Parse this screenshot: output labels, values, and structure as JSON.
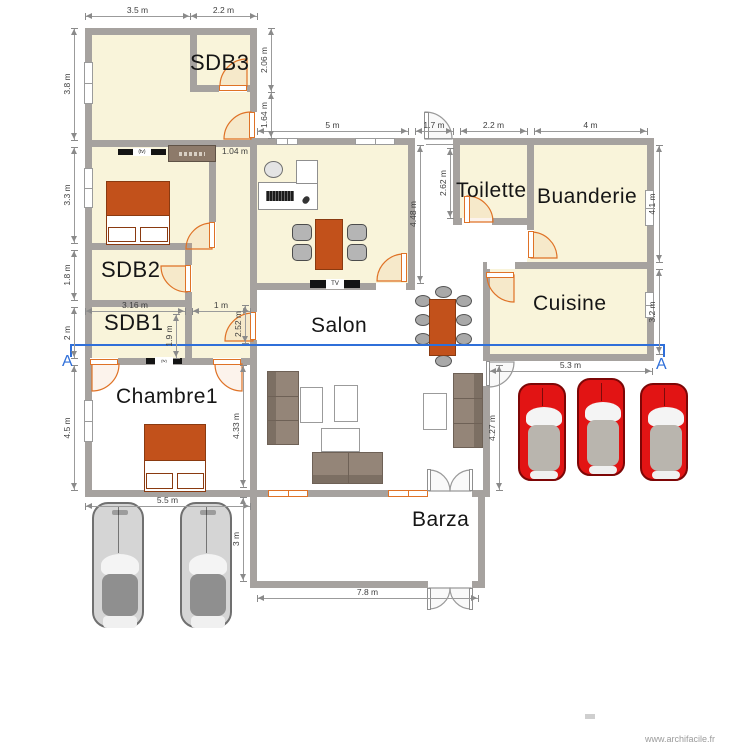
{
  "watermark": {
    "text": "www.archifacile.fr"
  },
  "plan": {
    "colors": {
      "room_fill": "#f9f4da",
      "wall": "#a6a29f",
      "door": "#df7226",
      "bed": "#c2511b",
      "bed_border": "#8a3a10",
      "wardrobe": "#8d7a6a",
      "chair": "#b5b5b5",
      "sofa": "#948578",
      "sofa_dark": "#7c6f63",
      "sofa_border": "#6e6156",
      "car_red": "#e21414",
      "car_gray": "#d5d5d5",
      "section": "#2f6fd9",
      "dim_line": "#9b9b9b",
      "dim": "#8a8a8a",
      "dim_text": "#3f3f3f"
    },
    "rooms_beige": [
      [
        85,
        28,
        172,
        119
      ],
      [
        85,
        140,
        172,
        225
      ],
      [
        250,
        138,
        165,
        152
      ],
      [
        453,
        138,
        81,
        87
      ],
      [
        527,
        138,
        127,
        131
      ],
      [
        483,
        262,
        171,
        99
      ]
    ],
    "walls": [
      [
        85,
        28,
        172,
        7
      ],
      [
        85,
        28,
        7,
        119
      ],
      [
        190,
        28,
        7,
        64
      ],
      [
        250,
        28,
        7,
        119
      ],
      [
        190,
        85,
        67,
        7
      ],
      [
        85,
        140,
        172,
        7
      ],
      [
        85,
        140,
        7,
        225
      ],
      [
        209,
        147,
        7,
        101
      ],
      [
        85,
        243,
        107,
        7
      ],
      [
        185,
        243,
        7,
        122
      ],
      [
        85,
        300,
        107,
        7
      ],
      [
        250,
        147,
        7,
        218
      ],
      [
        85,
        358,
        172,
        7
      ],
      [
        85,
        358,
        7,
        139
      ],
      [
        250,
        365,
        7,
        132
      ],
      [
        85,
        490,
        172,
        7
      ],
      [
        250,
        138,
        165,
        7
      ],
      [
        408,
        138,
        7,
        152
      ],
      [
        250,
        283,
        165,
        7
      ],
      [
        453,
        138,
        201,
        7
      ],
      [
        453,
        138,
        7,
        87
      ],
      [
        453,
        218,
        81,
        7
      ],
      [
        527,
        138,
        7,
        99
      ],
      [
        483,
        262,
        171,
        7
      ],
      [
        647,
        138,
        7,
        223
      ],
      [
        483,
        262,
        7,
        99
      ],
      [
        483,
        354,
        171,
        7
      ],
      [
        483,
        354,
        7,
        143
      ],
      [
        250,
        490,
        235,
        7
      ],
      [
        250,
        490,
        7,
        98
      ],
      [
        478,
        490,
        7,
        98
      ],
      [
        250,
        581,
        235,
        7
      ]
    ],
    "door_openings": [
      [
        219,
        85,
        28,
        7
      ],
      [
        250,
        112,
        7,
        26
      ],
      [
        209,
        222,
        7,
        26
      ],
      [
        185,
        265,
        7,
        27
      ],
      [
        250,
        312,
        7,
        28
      ],
      [
        90,
        358,
        28,
        7
      ],
      [
        213,
        358,
        28,
        7
      ],
      [
        462,
        218,
        30,
        7
      ],
      [
        527,
        230,
        7,
        28
      ],
      [
        487,
        262,
        28,
        7
      ],
      [
        376,
        283,
        30,
        7
      ],
      [
        428,
        490,
        44,
        7
      ],
      [
        428,
        581,
        44,
        7
      ],
      [
        483,
        361,
        7,
        25
      ]
    ],
    "thresholds": [
      [
        426,
        138,
        27,
        7
      ]
    ],
    "windows_white": [
      [
        84,
        62,
        9,
        42
      ],
      [
        84,
        168,
        9,
        40
      ],
      [
        84,
        400,
        9,
        42
      ],
      [
        276,
        138,
        22,
        7
      ],
      [
        355,
        138,
        40,
        7
      ],
      [
        645,
        190,
        9,
        36
      ],
      [
        645,
        292,
        9,
        26
      ]
    ],
    "windows_orange": [
      [
        268,
        490,
        40,
        7
      ],
      [
        388,
        490,
        40,
        7
      ]
    ],
    "door_leaves": [
      [
        219,
        85,
        28,
        6,
        "o"
      ],
      [
        249,
        112,
        6,
        26,
        "o"
      ],
      [
        209,
        222,
        6,
        26,
        "o"
      ],
      [
        185,
        265,
        6,
        27,
        "o"
      ],
      [
        250,
        312,
        6,
        28,
        "o"
      ],
      [
        90,
        359,
        28,
        6,
        "o"
      ],
      [
        213,
        359,
        28,
        6,
        "o"
      ],
      [
        424,
        112,
        5,
        27,
        "g"
      ],
      [
        464,
        196,
        6,
        27,
        "o"
      ],
      [
        528,
        231,
        6,
        27,
        "o"
      ],
      [
        486,
        272,
        28,
        6,
        "o"
      ],
      [
        401,
        253,
        6,
        29,
        "o"
      ],
      [
        427,
        469,
        4,
        22,
        "g"
      ],
      [
        469,
        469,
        4,
        22,
        "g"
      ],
      [
        427,
        588,
        4,
        22,
        "g"
      ],
      [
        469,
        588,
        4,
        22,
        "g"
      ],
      [
        486,
        361,
        4,
        25,
        "g"
      ]
    ],
    "door_arcs": [
      [
        247,
        86,
        27,
        180,
        270,
        "o"
      ],
      [
        251,
        139,
        27,
        270,
        180,
        "o"
      ],
      [
        212,
        249,
        26,
        270,
        180,
        "o"
      ],
      [
        187,
        266,
        26,
        90,
        180,
        "o"
      ],
      [
        253,
        341,
        28,
        270,
        180,
        "o"
      ],
      [
        92,
        364,
        27,
        0,
        90,
        "o"
      ],
      [
        242,
        364,
        27,
        180,
        90,
        "o"
      ],
      [
        425,
        139,
        27,
        270,
        0,
        "g"
      ],
      [
        467,
        222,
        26,
        270,
        0,
        "o"
      ],
      [
        531,
        258,
        26,
        270,
        0,
        "o"
      ],
      [
        514,
        275,
        27,
        180,
        90,
        "o"
      ],
      [
        404,
        281,
        27,
        270,
        180,
        "o"
      ],
      [
        429,
        491,
        21,
        270,
        0,
        "g"
      ],
      [
        471,
        491,
        21,
        270,
        180,
        "g"
      ],
      [
        429,
        588,
        21,
        90,
        0,
        "g"
      ],
      [
        471,
        588,
        21,
        90,
        180,
        "g"
      ],
      [
        489,
        362,
        25,
        90,
        0,
        "g"
      ]
    ],
    "dims_h": [
      [
        85,
        190,
        16,
        "3.5 m"
      ],
      [
        190,
        257,
        16,
        "2.2 m"
      ],
      [
        257,
        408,
        131,
        "5 m"
      ],
      [
        415,
        453,
        131,
        "1.7 m"
      ],
      [
        460,
        527,
        131,
        "2.2 m"
      ],
      [
        534,
        647,
        131,
        "4 m"
      ],
      [
        85,
        185,
        311,
        "3.16 m"
      ],
      [
        192,
        250,
        311,
        "1 m"
      ],
      [
        489,
        652,
        371,
        "5.3 m"
      ],
      [
        85,
        250,
        506,
        "5.5 m"
      ],
      [
        257,
        478,
        598,
        "7.8 m"
      ]
    ],
    "dims_v": [
      [
        74,
        28,
        140,
        "3.8 m"
      ],
      [
        74,
        147,
        243,
        "3.3 m"
      ],
      [
        74,
        250,
        300,
        "1.8 m"
      ],
      [
        74,
        307,
        358,
        "2 m"
      ],
      [
        74,
        365,
        490,
        "4.5 m"
      ],
      [
        271,
        28,
        92,
        "2.06 m"
      ],
      [
        271,
        92,
        138,
        "1.64 m"
      ],
      [
        176,
        314,
        358,
        "1.9 m"
      ],
      [
        245,
        305,
        343,
        "2.52 m"
      ],
      [
        420,
        145,
        283,
        "4.48 m"
      ],
      [
        450,
        148,
        218,
        "2.62 m"
      ],
      [
        659,
        145,
        262,
        "4.1 m"
      ],
      [
        659,
        269,
        354,
        "3.2 m"
      ],
      [
        499,
        365,
        490,
        "4.27 m"
      ],
      [
        243,
        365,
        487,
        "4.33 m"
      ],
      [
        243,
        497,
        581,
        "3 m"
      ]
    ],
    "dim_labels_free": [
      [
        222,
        146,
        "1.04 m"
      ]
    ],
    "room_labels": [
      [
        190,
        50,
        22,
        "SDB3"
      ],
      [
        101,
        257,
        22,
        "SDB2"
      ],
      [
        104,
        310,
        22,
        "SDB1"
      ],
      [
        116,
        385,
        21,
        "Chambre1"
      ],
      [
        311,
        314,
        21,
        "Salon"
      ],
      [
        456,
        179,
        21,
        "Toilette"
      ],
      [
        537,
        185,
        21,
        "Buanderie"
      ],
      [
        533,
        292,
        21,
        "Cuisine"
      ],
      [
        412,
        508,
        21,
        "Barza"
      ]
    ],
    "section": {
      "label": "A",
      "x1": 71,
      "x2": 664,
      "y": 344
    },
    "furniture": {
      "beds": [
        [
          106,
          181,
          64,
          64
        ],
        [
          144,
          424,
          62,
          68
        ]
      ],
      "wardrobe": [
        168,
        145,
        48,
        17
      ],
      "tvs": [
        [
          118,
          149,
          48,
          6,
          "(tv)",
          5
        ],
        [
          146,
          358,
          36,
          6,
          "(tv)",
          4
        ],
        [
          310,
          280,
          50,
          8,
          "TV",
          6
        ]
      ],
      "desk_parts": [
        [
          258,
          182,
          60,
          28
        ],
        [
          296,
          160,
          22,
          24
        ]
      ],
      "desk_chair": [
        264,
        161,
        19,
        17
      ],
      "keyboard": [
        266,
        191,
        28,
        10
      ],
      "mouse": [
        303,
        196,
        6,
        8
      ],
      "tables": [
        [
          315,
          219,
          28,
          51
        ],
        [
          429,
          299,
          27,
          57
        ]
      ],
      "chairs_rect": [
        [
          292,
          224,
          20,
          17
        ],
        [
          292,
          244,
          20,
          17
        ],
        [
          347,
          224,
          20,
          17
        ],
        [
          347,
          244,
          20,
          17
        ]
      ],
      "chairs_ellipse": [
        [
          435,
          286,
          17,
          12
        ],
        [
          435,
          355,
          17,
          12
        ],
        [
          415,
          295,
          16,
          12
        ],
        [
          415,
          314,
          16,
          12
        ],
        [
          415,
          333,
          16,
          12
        ],
        [
          456,
          295,
          16,
          12
        ],
        [
          456,
          314,
          16,
          12
        ],
        [
          456,
          333,
          16,
          12
        ]
      ],
      "sofas": [
        [
          267,
          371,
          32,
          74,
          "v"
        ],
        [
          312,
          452,
          71,
          32,
          "h"
        ],
        [
          453,
          373,
          30,
          75,
          "vr"
        ]
      ],
      "white_tables": [
        [
          300,
          387,
          23,
          36
        ],
        [
          334,
          385,
          24,
          37
        ],
        [
          321,
          428,
          39,
          24
        ],
        [
          423,
          393,
          24,
          37
        ]
      ],
      "cars_red": [
        [
          518,
          383
        ],
        [
          577,
          378
        ],
        [
          640,
          383
        ]
      ],
      "cars_gray": [
        [
          92,
          502
        ],
        [
          180,
          502
        ]
      ]
    },
    "decorations": [
      [
        585,
        714,
        10,
        5
      ]
    ]
  }
}
